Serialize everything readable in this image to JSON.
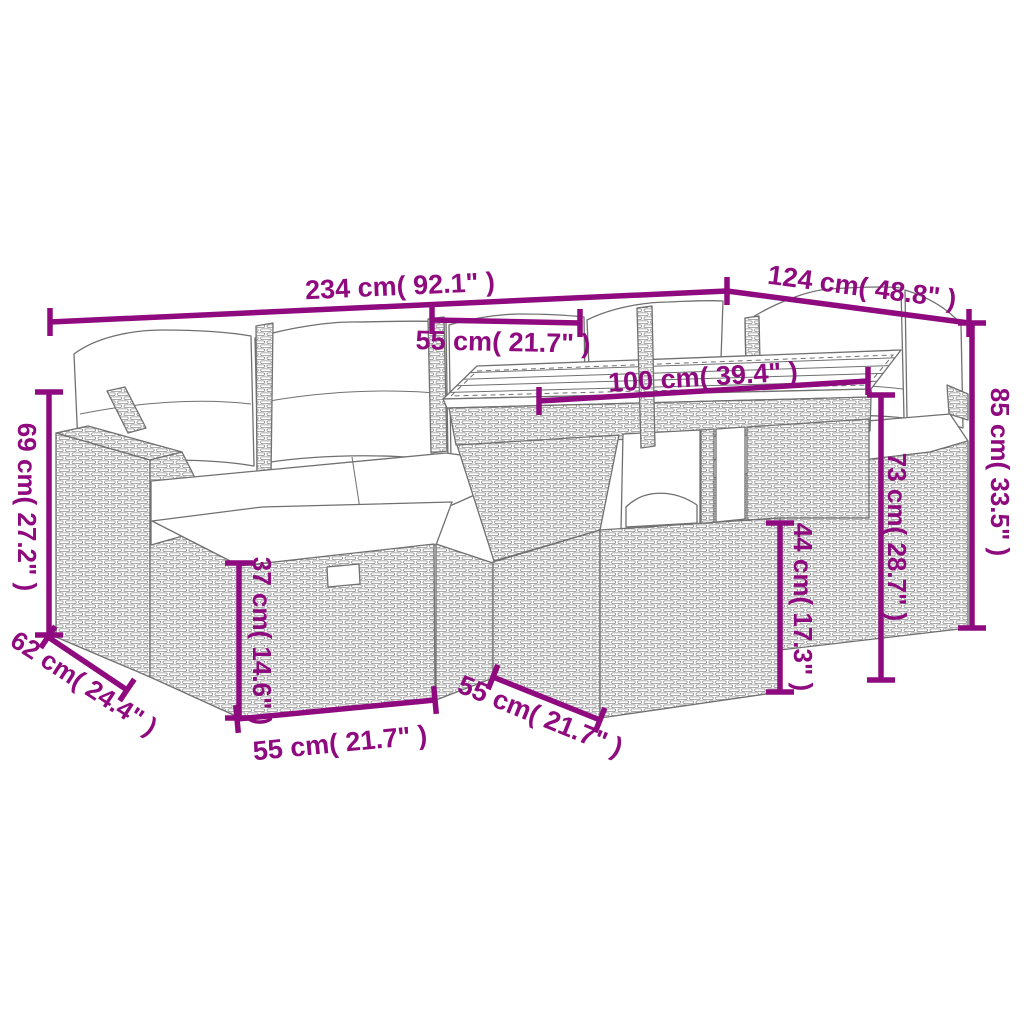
{
  "diagram": {
    "type": "product-dimension-diagram",
    "colors": {
      "dimension": "#8e0a7e",
      "linework": "#707070",
      "background": "#ffffff"
    },
    "dimensions": {
      "overall_width": "234 cm( 92.1\" )",
      "right_section_width": "124 cm( 48.8\" )",
      "seat_width": "55 cm( 21.7\" )",
      "table_top_length": "100 cm( 39.4\" )",
      "armrest_height": "69 cm( 27.2\" )",
      "armrest_depth": "62 cm( 24.4\" )",
      "ottoman_height": "37 cm( 14.6\" )",
      "ottoman_width": "55 cm( 21.7\" )",
      "table_base_depth": "55 cm( 21.7\" )",
      "table_base_height": "44 cm( 17.3\" )",
      "table_height": "73 cm( 28.7\" )",
      "backrest_height": "85 cm( 33.5\" )"
    }
  }
}
